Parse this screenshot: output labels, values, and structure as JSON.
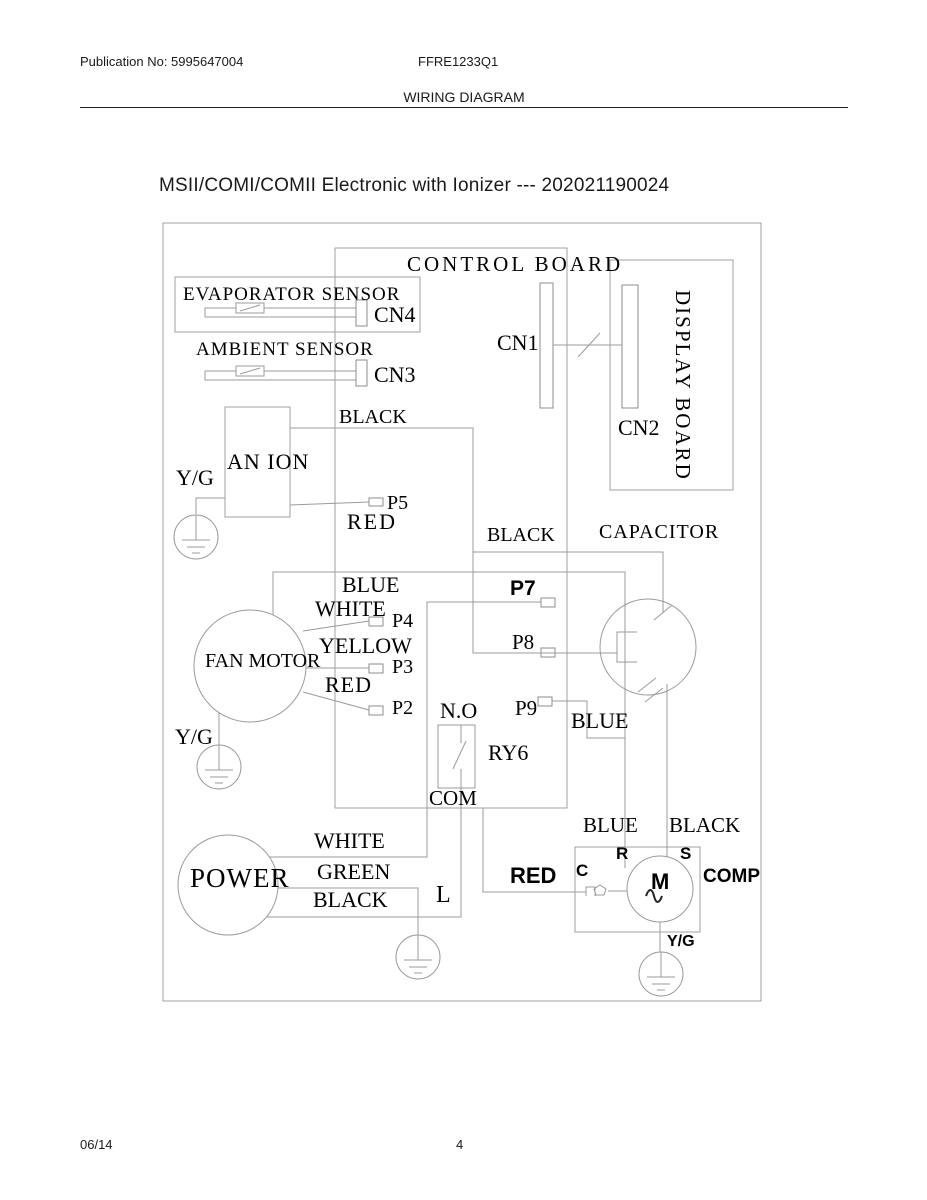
{
  "header": {
    "publication": "Publication No: 5995647004",
    "model": "FFRE1233Q1",
    "section": "WIRING DIAGRAM"
  },
  "title": "MSII/COMI/COMII Electronic with Ionizer --- 202021190024",
  "diagram": {
    "components": {
      "control_board": "CONTROL BOARD",
      "evaporator_sensor": "EVAPORATOR SENSOR",
      "ambient_sensor": "AMBIENT SENSOR",
      "anion": "AN ION",
      "fan_motor": "FAN MOTOR",
      "capacitor": "CAPACITOR",
      "display_board": "DISPLAY BOARD",
      "power": "POWER",
      "comp": "COMP",
      "relay": "RY6",
      "motor_m": "M"
    },
    "connectors": {
      "cn1": "CN1",
      "cn2": "CN2",
      "cn3": "CN3",
      "cn4": "CN4",
      "p2": "P2",
      "p3": "P3",
      "p4": "P4",
      "p5": "P5",
      "p7": "P7",
      "p8": "P8",
      "p9": "P9"
    },
    "wires": {
      "black_anion": "BLACK",
      "red_anion": "RED",
      "black_cap": "BLACK",
      "blue_fan": "BLUE",
      "white_fan": "WHITE",
      "yellow_fan": "YELLOW",
      "red_fan": "RED",
      "blue_p9": "BLUE",
      "white_power": "WHITE",
      "green_power": "GREEN",
      "black_power": "BLACK",
      "red_comp": "RED",
      "blue_comp": "BLUE",
      "black_comp": "BLACK"
    },
    "terminals": {
      "no": "N.O",
      "com": "COM",
      "l": "L",
      "c": "C",
      "r": "R",
      "s": "S",
      "yg_anion": "Y/G",
      "yg_fan": "Y/G",
      "yg_comp": "Y/G"
    }
  },
  "footer": {
    "date": "06/14",
    "page": "4"
  }
}
